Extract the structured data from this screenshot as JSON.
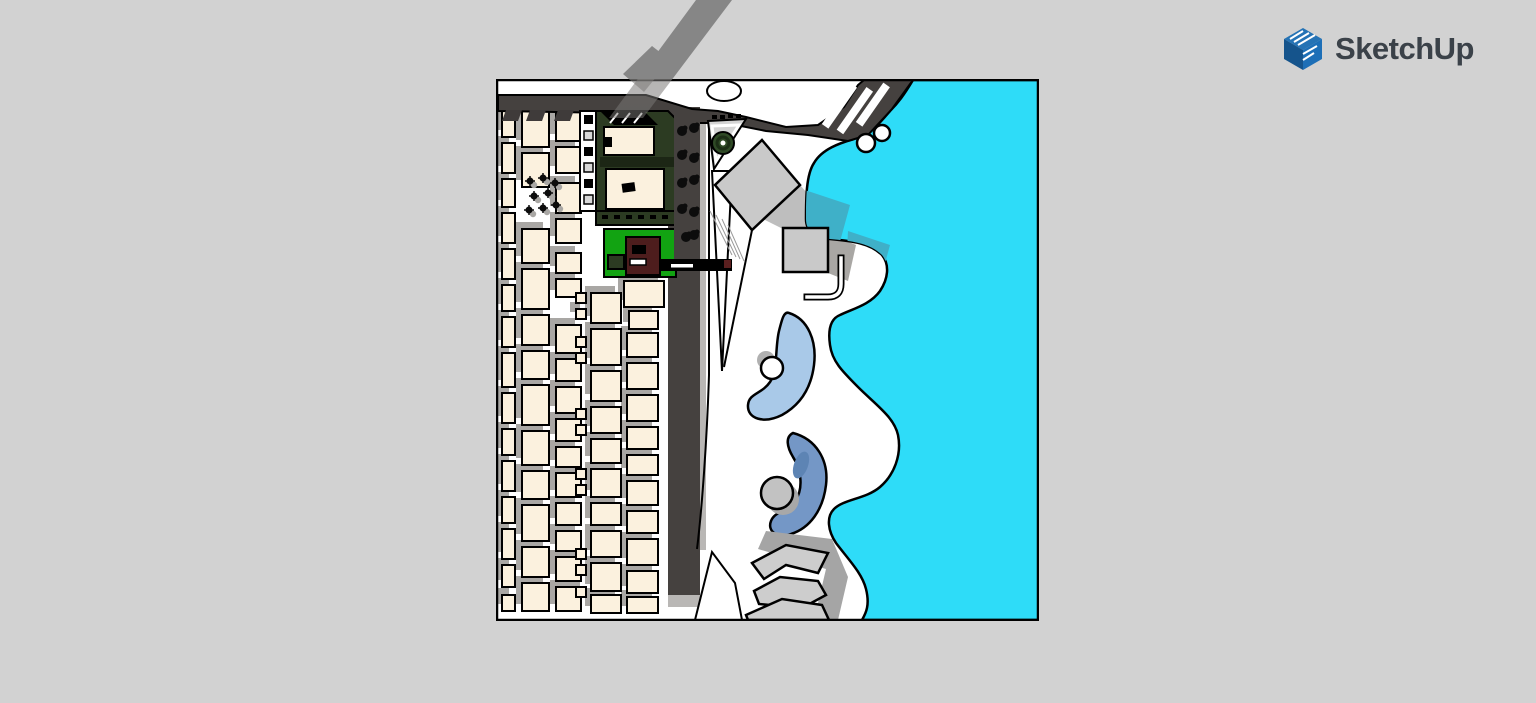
{
  "app": {
    "logo_text": "SketchUp"
  },
  "colors": {
    "background": "#d2d2d2",
    "canvas": "#ffffff",
    "outline": "#000000",
    "road": "#45413f",
    "road_edge": "#b9b7b5",
    "roof": "#3f3b3a",
    "band": "#868686",
    "water": "#2edcf8",
    "water_shadow": "#3fb0c8",
    "building": "#fbf1de",
    "shadow": "#a9a7a4",
    "plaza": "#c9c9c9",
    "terrace": "#cdcdcd",
    "terrace_shadow": "#a5a5a5",
    "lawn": "#12a312",
    "tree": "#2f4a26",
    "maroon": "#4d1d1d",
    "complex": "#2c3b22",
    "pool_light": "#a9c9e8",
    "pool_steel": "#7497c6",
    "pool_steel_dark": "#5d84b4",
    "island_gray": "#c2c2c2",
    "logo_blue": "#1d6fb7",
    "logo_blue_dark": "#15548c",
    "logo_blue_top": "#2573b5",
    "logo_text_color": "#3b4249"
  },
  "scene": {
    "buildings": [
      [
        6,
        30,
        13,
        28
      ],
      [
        6,
        64,
        13,
        30
      ],
      [
        6,
        100,
        13,
        28
      ],
      [
        6,
        134,
        13,
        30
      ],
      [
        6,
        170,
        13,
        30
      ],
      [
        6,
        206,
        13,
        26
      ],
      [
        6,
        238,
        13,
        30
      ],
      [
        6,
        274,
        13,
        34
      ],
      [
        6,
        314,
        13,
        30
      ],
      [
        6,
        350,
        13,
        26
      ],
      [
        6,
        382,
        13,
        30
      ],
      [
        6,
        418,
        13,
        26
      ],
      [
        6,
        450,
        13,
        30
      ],
      [
        6,
        486,
        13,
        22
      ],
      [
        6,
        516,
        13,
        16
      ],
      [
        26,
        30,
        27,
        38
      ],
      [
        26,
        74,
        27,
        34
      ],
      [
        26,
        150,
        27,
        34
      ],
      [
        26,
        190,
        27,
        40
      ],
      [
        26,
        236,
        27,
        30
      ],
      [
        26,
        272,
        27,
        28
      ],
      [
        26,
        306,
        27,
        40
      ],
      [
        26,
        352,
        27,
        34
      ],
      [
        26,
        392,
        27,
        28
      ],
      [
        26,
        426,
        27,
        36
      ],
      [
        26,
        468,
        27,
        30
      ],
      [
        26,
        504,
        27,
        28
      ],
      [
        60,
        32,
        25,
        30
      ],
      [
        60,
        68,
        25,
        26
      ],
      [
        60,
        104,
        25,
        30
      ],
      [
        60,
        140,
        25,
        24
      ],
      [
        60,
        174,
        25,
        20
      ],
      [
        60,
        200,
        25,
        18
      ],
      [
        60,
        246,
        25,
        28
      ],
      [
        60,
        280,
        25,
        22
      ],
      [
        60,
        308,
        25,
        26
      ],
      [
        60,
        340,
        25,
        22
      ],
      [
        60,
        368,
        25,
        20
      ],
      [
        60,
        394,
        25,
        24
      ],
      [
        60,
        424,
        25,
        22
      ],
      [
        60,
        452,
        25,
        20
      ],
      [
        60,
        478,
        25,
        24
      ],
      [
        60,
        508,
        25,
        24
      ],
      [
        80,
        214,
        10,
        10
      ],
      [
        80,
        230,
        10,
        10
      ],
      [
        80,
        258,
        10,
        10
      ],
      [
        80,
        274,
        10,
        10
      ],
      [
        80,
        330,
        10,
        10
      ],
      [
        80,
        346,
        10,
        10
      ],
      [
        80,
        390,
        10,
        10
      ],
      [
        80,
        406,
        10,
        10
      ],
      [
        80,
        470,
        10,
        10
      ],
      [
        80,
        486,
        10,
        10
      ],
      [
        80,
        508,
        10,
        10
      ],
      [
        95,
        214,
        30,
        30
      ],
      [
        95,
        250,
        30,
        36
      ],
      [
        95,
        292,
        30,
        30
      ],
      [
        95,
        328,
        30,
        26
      ],
      [
        95,
        360,
        30,
        24
      ],
      [
        95,
        390,
        30,
        28
      ],
      [
        95,
        424,
        30,
        22
      ],
      [
        95,
        452,
        30,
        26
      ],
      [
        95,
        484,
        30,
        28
      ],
      [
        95,
        516,
        30,
        18
      ],
      [
        128,
        202,
        40,
        26
      ],
      [
        133,
        232,
        29,
        18
      ],
      [
        131,
        254,
        31,
        24
      ],
      [
        131,
        284,
        31,
        26
      ],
      [
        131,
        316,
        31,
        26
      ],
      [
        131,
        348,
        31,
        22
      ],
      [
        131,
        376,
        31,
        20
      ],
      [
        131,
        402,
        31,
        24
      ],
      [
        131,
        432,
        31,
        22
      ],
      [
        131,
        460,
        31,
        26
      ],
      [
        131,
        492,
        31,
        22
      ],
      [
        131,
        518,
        31,
        16
      ]
    ],
    "street_trees": [
      [
        186,
        52
      ],
      [
        198,
        49
      ],
      [
        186,
        76
      ],
      [
        198,
        79
      ],
      [
        186,
        104
      ],
      [
        198,
        101
      ],
      [
        186,
        130
      ],
      [
        198,
        133
      ],
      [
        190,
        158
      ],
      [
        198,
        156
      ]
    ],
    "cluster_trees": [
      [
        34,
        102
      ],
      [
        47,
        99
      ],
      [
        59,
        104
      ],
      [
        38,
        117
      ],
      [
        52,
        114
      ],
      [
        33,
        131
      ],
      [
        47,
        129
      ],
      [
        60,
        126
      ]
    ]
  }
}
